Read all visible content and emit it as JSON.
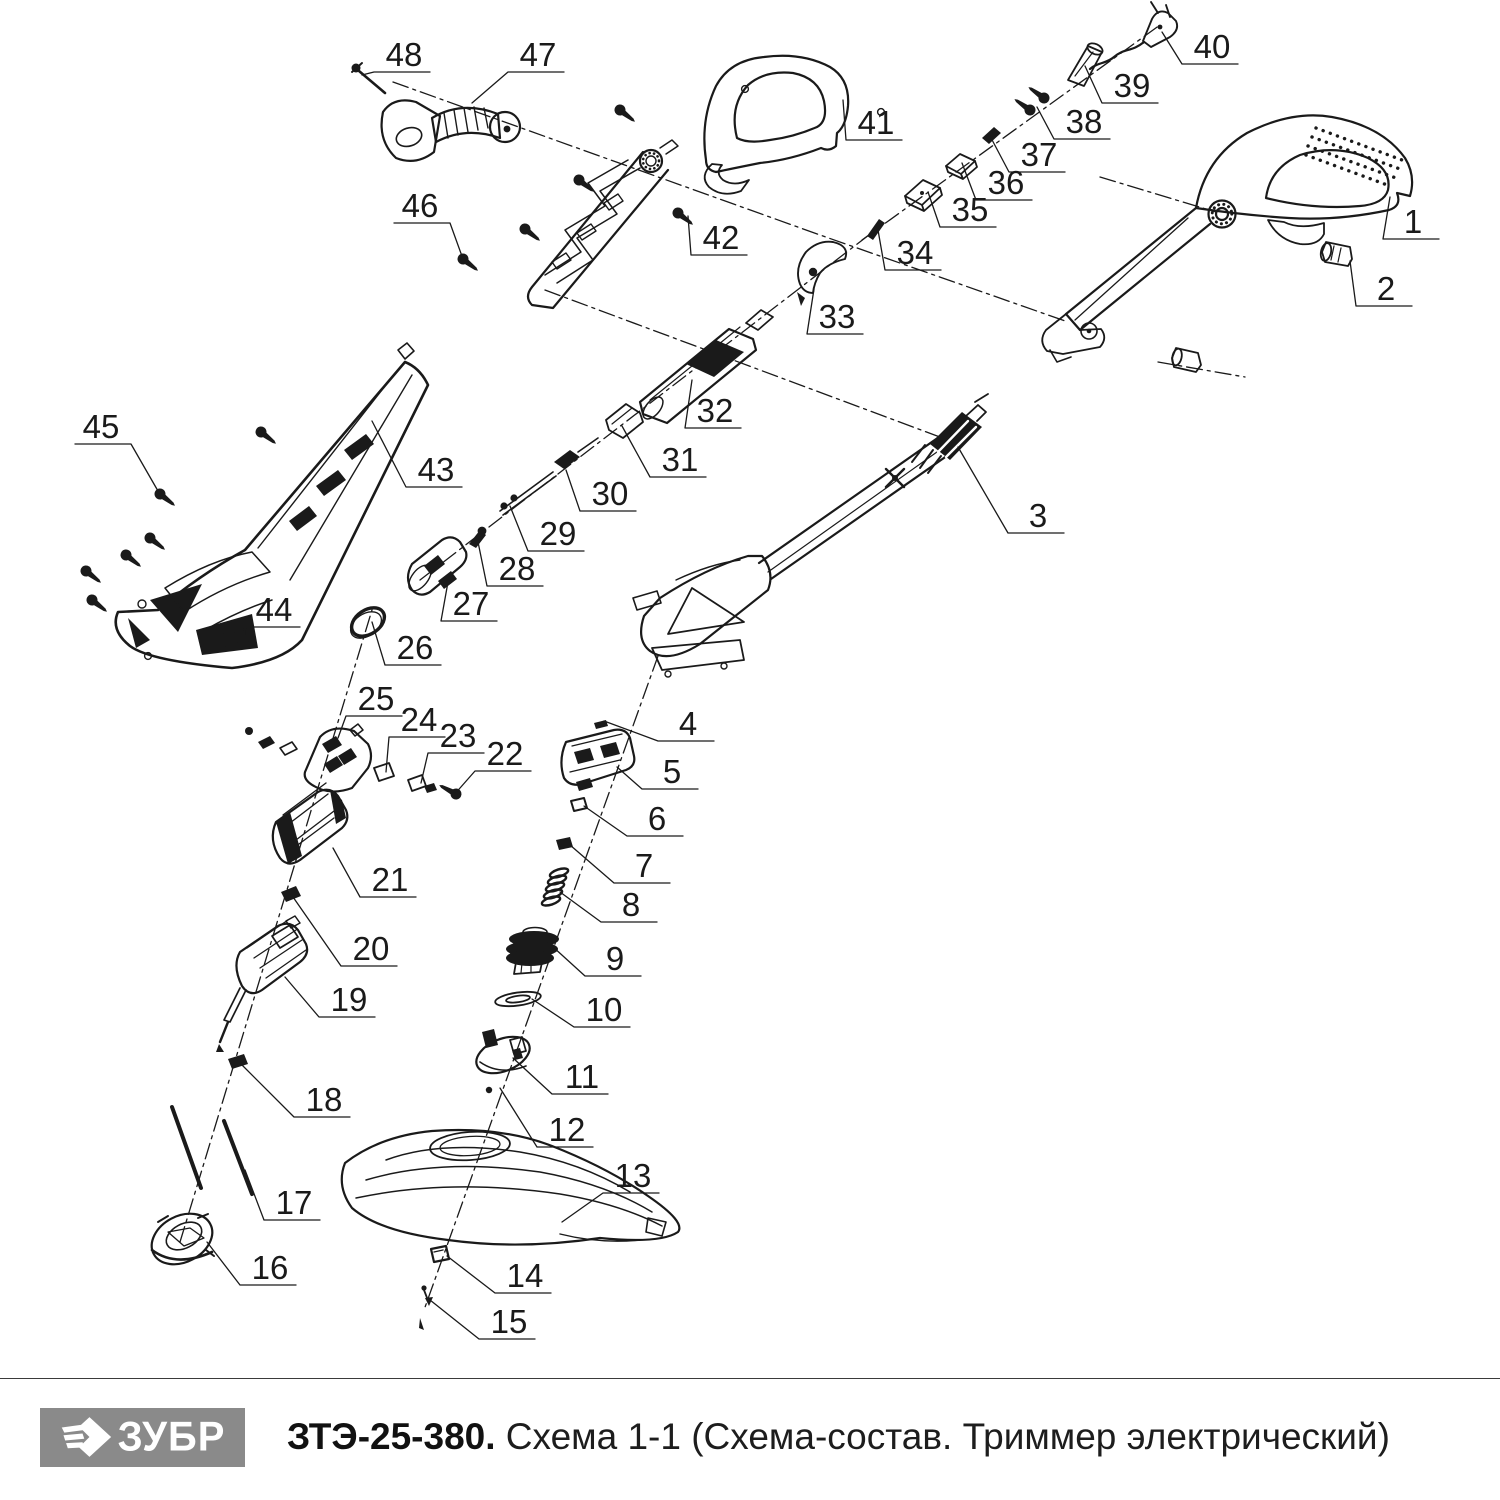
{
  "footer": {
    "logo_text": "ЗУБР",
    "logo_bg": "#8a8a8a",
    "model": "ЗТЭ-25-380.",
    "subtitle": " Схема 1-1 (Схема-состав. Триммер электрический)"
  },
  "diagram": {
    "type": "exploded-parts-diagram",
    "subject": "Триммер электрический",
    "line_color": "#1a1a1a",
    "callouts": [
      {
        "n": "1",
        "x": 1413,
        "y": 222,
        "tx": 1390,
        "ty": 197
      },
      {
        "n": "2",
        "x": 1386,
        "y": 289,
        "tx": 1350,
        "ty": 261
      },
      {
        "n": "3",
        "x": 1038,
        "y": 516,
        "tx": 958,
        "ty": 447
      },
      {
        "n": "4",
        "x": 688,
        "y": 724,
        "tx": 604,
        "ty": 721
      },
      {
        "n": "5",
        "x": 672,
        "y": 772,
        "tx": 617,
        "ty": 767
      },
      {
        "n": "6",
        "x": 657,
        "y": 819,
        "tx": 584,
        "ty": 806
      },
      {
        "n": "7",
        "x": 644,
        "y": 866,
        "tx": 570,
        "ty": 845
      },
      {
        "n": "8",
        "x": 631,
        "y": 905,
        "tx": 560,
        "ty": 892
      },
      {
        "n": "9",
        "x": 615,
        "y": 959,
        "tx": 552,
        "ty": 946
      },
      {
        "n": "10",
        "x": 604,
        "y": 1010,
        "tx": 532,
        "ty": 999
      },
      {
        "n": "11",
        "x": 582,
        "y": 1077,
        "tx": 513,
        "ty": 1058
      },
      {
        "n": "12",
        "x": 567,
        "y": 1130,
        "tx": 500,
        "ty": 1088
      },
      {
        "n": "13",
        "x": 633,
        "y": 1176,
        "tx": 562,
        "ty": 1222
      },
      {
        "n": "14",
        "x": 525,
        "y": 1276,
        "tx": 447,
        "ty": 1256
      },
      {
        "n": "15",
        "x": 509,
        "y": 1322,
        "tx": 430,
        "ty": 1300
      },
      {
        "n": "16",
        "x": 270,
        "y": 1268,
        "tx": 207,
        "ty": 1242
      },
      {
        "n": "17",
        "x": 294,
        "y": 1203,
        "tx": 245,
        "ty": 1170
      },
      {
        "n": "18",
        "x": 324,
        "y": 1100,
        "tx": 240,
        "ty": 1063
      },
      {
        "n": "19",
        "x": 349,
        "y": 1000,
        "tx": 285,
        "ty": 977
      },
      {
        "n": "20",
        "x": 371,
        "y": 949,
        "tx": 293,
        "ty": 897
      },
      {
        "n": "21",
        "x": 390,
        "y": 880,
        "tx": 333,
        "ty": 848
      },
      {
        "n": "22",
        "x": 505,
        "y": 754,
        "tx": 453,
        "ty": 796
      },
      {
        "n": "23",
        "x": 458,
        "y": 736,
        "tx": 421,
        "ty": 783
      },
      {
        "n": "24",
        "x": 419,
        "y": 720,
        "tx": 386,
        "ty": 772
      },
      {
        "n": "25",
        "x": 376,
        "y": 699,
        "tx": 338,
        "ty": 738
      },
      {
        "n": "26",
        "x": 415,
        "y": 648,
        "tx": 372,
        "ty": 622
      },
      {
        "n": "27",
        "x": 471,
        "y": 604,
        "tx": 448,
        "ty": 582
      },
      {
        "n": "28",
        "x": 517,
        "y": 569,
        "tx": 477,
        "ty": 537
      },
      {
        "n": "29",
        "x": 558,
        "y": 534,
        "tx": 510,
        "ty": 506
      },
      {
        "n": "30",
        "x": 610,
        "y": 494,
        "tx": 566,
        "ty": 470
      },
      {
        "n": "31",
        "x": 680,
        "y": 460,
        "tx": 622,
        "ty": 426
      },
      {
        "n": "32",
        "x": 715,
        "y": 411,
        "tx": 692,
        "ty": 380
      },
      {
        "n": "33",
        "x": 837,
        "y": 317,
        "tx": 814,
        "ty": 289
      },
      {
        "n": "34",
        "x": 915,
        "y": 253,
        "tx": 878,
        "ty": 230
      },
      {
        "n": "35",
        "x": 970,
        "y": 210,
        "tx": 928,
        "ty": 192
      },
      {
        "n": "36",
        "x": 1006,
        "y": 183,
        "tx": 962,
        "ty": 163
      },
      {
        "n": "37",
        "x": 1039,
        "y": 155,
        "tx": 990,
        "ty": 136
      },
      {
        "n": "38",
        "x": 1084,
        "y": 122,
        "tx": 1037,
        "ty": 107
      },
      {
        "n": "39",
        "x": 1132,
        "y": 86,
        "tx": 1085,
        "ty": 66
      },
      {
        "n": "40",
        "x": 1212,
        "y": 47,
        "tx": 1162,
        "ty": 32
      },
      {
        "n": "41",
        "x": 876,
        "y": 123,
        "tx": 843,
        "ty": 100
      },
      {
        "n": "42",
        "x": 721,
        "y": 238,
        "tx": 688,
        "ty": 216
      },
      {
        "n": "43",
        "x": 436,
        "y": 470,
        "tx": 372,
        "ty": 421
      },
      {
        "n": "44",
        "x": 274,
        "y": 610,
        "tx": 245,
        "ty": 636
      },
      {
        "n": "45",
        "x": 101,
        "y": 427,
        "tx": 158,
        "ty": 491
      },
      {
        "n": "46",
        "x": 420,
        "y": 206,
        "tx": 463,
        "ty": 259
      },
      {
        "n": "47",
        "x": 538,
        "y": 55,
        "tx": 472,
        "ty": 103
      },
      {
        "n": "48",
        "x": 404,
        "y": 55,
        "tx": 362,
        "ty": 75
      }
    ]
  }
}
